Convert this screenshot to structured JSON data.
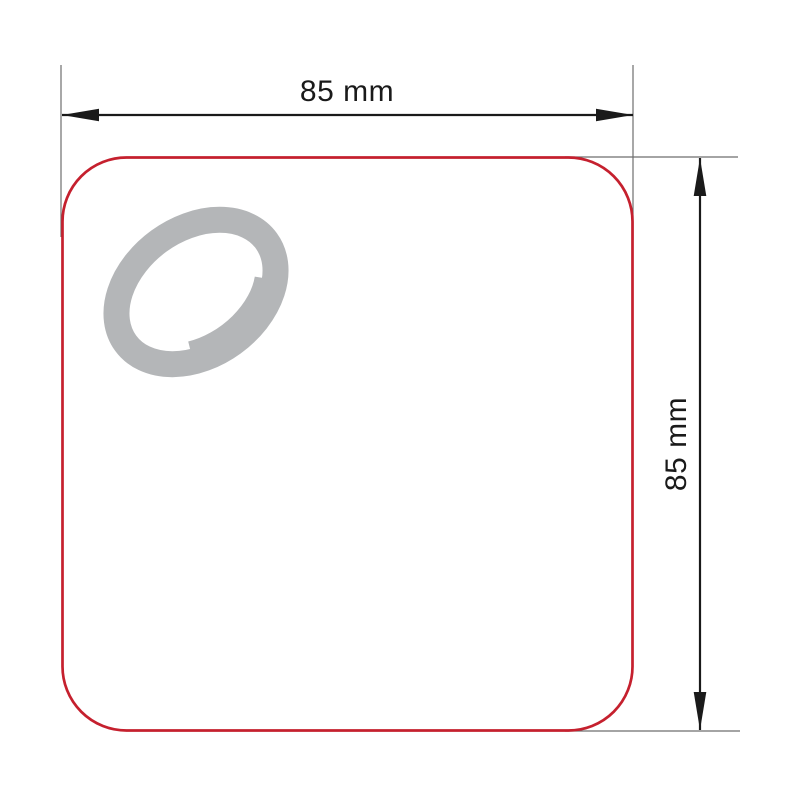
{
  "diagram": {
    "title": "product-dimension-drawing",
    "width_label": "85 mm",
    "height_label": "85 mm",
    "colors": {
      "background": "#ffffff",
      "outline_red": "#c5202e",
      "fill_white": "#ffffff",
      "ring_gray": "#b4b6b8",
      "dimension_black": "#1a1a1a",
      "extension_gray": "#6e6e6e"
    }
  }
}
